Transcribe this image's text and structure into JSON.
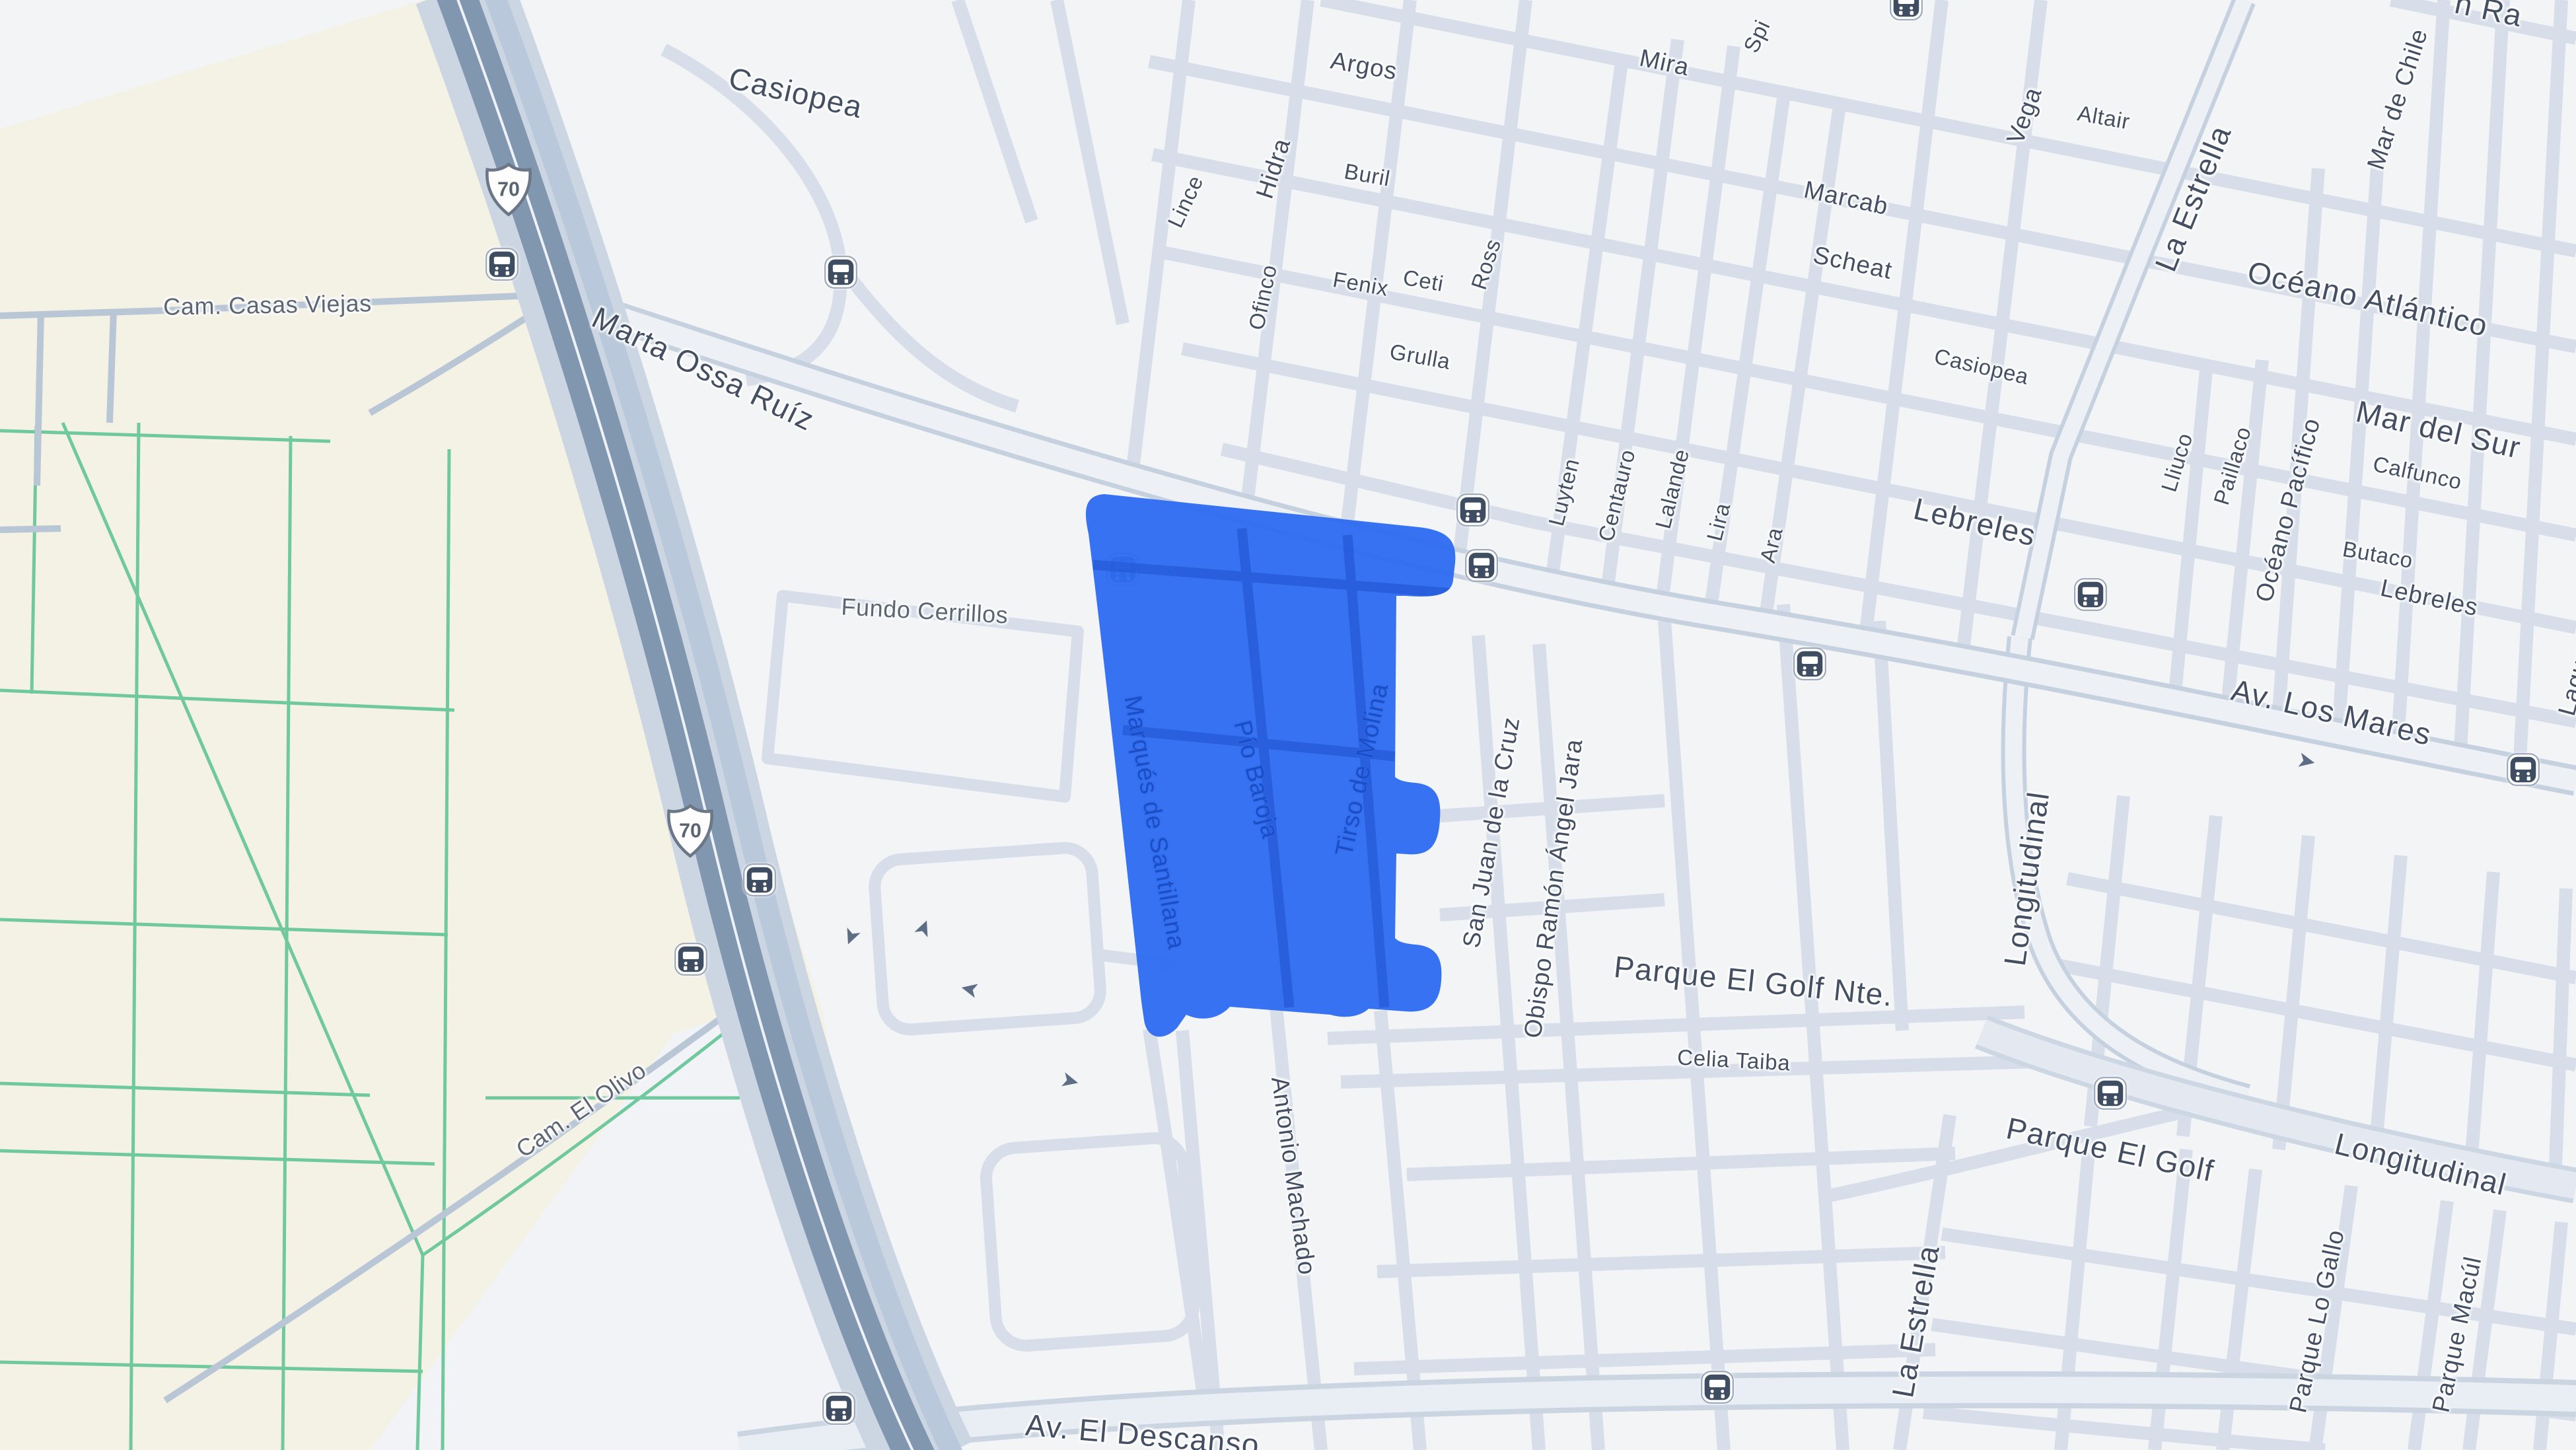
{
  "map": {
    "shield": {
      "number": "70"
    },
    "labels": {
      "casiopea_top": "Casiopea",
      "cam_casas_viejas": "Cam. Casas Viejas",
      "marta_ossa_ruiz": "Marta Ossa Ruíz",
      "lince": "Lince",
      "hidra": "Hidra",
      "argos": "Argos",
      "buril": "Buril",
      "fenix": "Fenix",
      "ross": "Ross",
      "mira": "Mira",
      "spi_partial": "Spi",
      "ofinco": "Ofinco",
      "ceti": "Ceti",
      "grulla": "Grulla",
      "marcab": "Marcab",
      "scheat": "Scheat",
      "casiopea_mid": "Casiopea",
      "vega": "Vega",
      "altair": "Altair",
      "la_estrella_north": "La Estrella",
      "mar_de_chile": "Mar de Chile",
      "corner_partial": "n Ra",
      "oceano_atlantico": "Océano Atlántico",
      "mar_del_sur": "Mar del Sur",
      "luyten": "Luyten",
      "centauro": "Centauro",
      "lalande": "Lalande",
      "lira": "Lira",
      "ara": "Ara",
      "lebreles_west": "Lebreles",
      "lliuco": "Lliuco",
      "paillaco": "Paillaco",
      "oceano_pacifico": "Océano Pacífico",
      "calfunco": "Calfunco",
      "butaco": "Butaco",
      "lebreles_east": "Lebreles",
      "av_los_mares": "Av. Los Mares",
      "laguna_partial": "Laguna",
      "longitudinal_vertical": "Longitudinal",
      "fundo_cerrillos": "Fundo Cerrillos",
      "marques_de_santillana": "Marqués de Santillana",
      "pio_baroja": "Pío Baroja",
      "tirso_de_molina": "Tirso de Molina",
      "san_juan_de_la_cruz": "San Juan de la Cruz",
      "obispo_ramon_angel_jara": "Obispo Ramón Ángel Jara",
      "parque_el_golf_nte": "Parque El Golf Nte.",
      "celia_taiba": "Celia Taiba",
      "cam_el_olivo": "Cam. El Olivo",
      "antonio_machado": "Antonio Machado",
      "longitudinal_diag": "Longitudinal",
      "parque_el_golf": "Parque El Golf",
      "la_estrella_south": "La Estrella",
      "parque_lo_gallo": "Parque Lo Gallo",
      "parque_macul": "Parque Macúl",
      "av_el_descanso": "Av. El Descanso"
    },
    "icons": {
      "bus_stop": "bus-stop-icon",
      "one_way_arrow": "one-way-arrow-icon",
      "one_way_glyph": "➤",
      "route_shield": "us-route-shield-icon"
    },
    "colors": {
      "selection_blue": "#2e6cf0",
      "selection_street_blue": "#2458d4",
      "urban_bg": "#f2f4f6",
      "rural_bg": "#f4f1e5",
      "road_minor": "#d7dee9",
      "road_major_casing": "#c6d1df",
      "road_major_fill": "#edf0f5",
      "highway_base": "#ccd6e3",
      "highway_stripe": "#8196af",
      "green_plot_line": "#6fc89e",
      "street_text": "#454f63",
      "locality_text": "#5d6673",
      "polygon_text": "#1c4dc2"
    }
  }
}
